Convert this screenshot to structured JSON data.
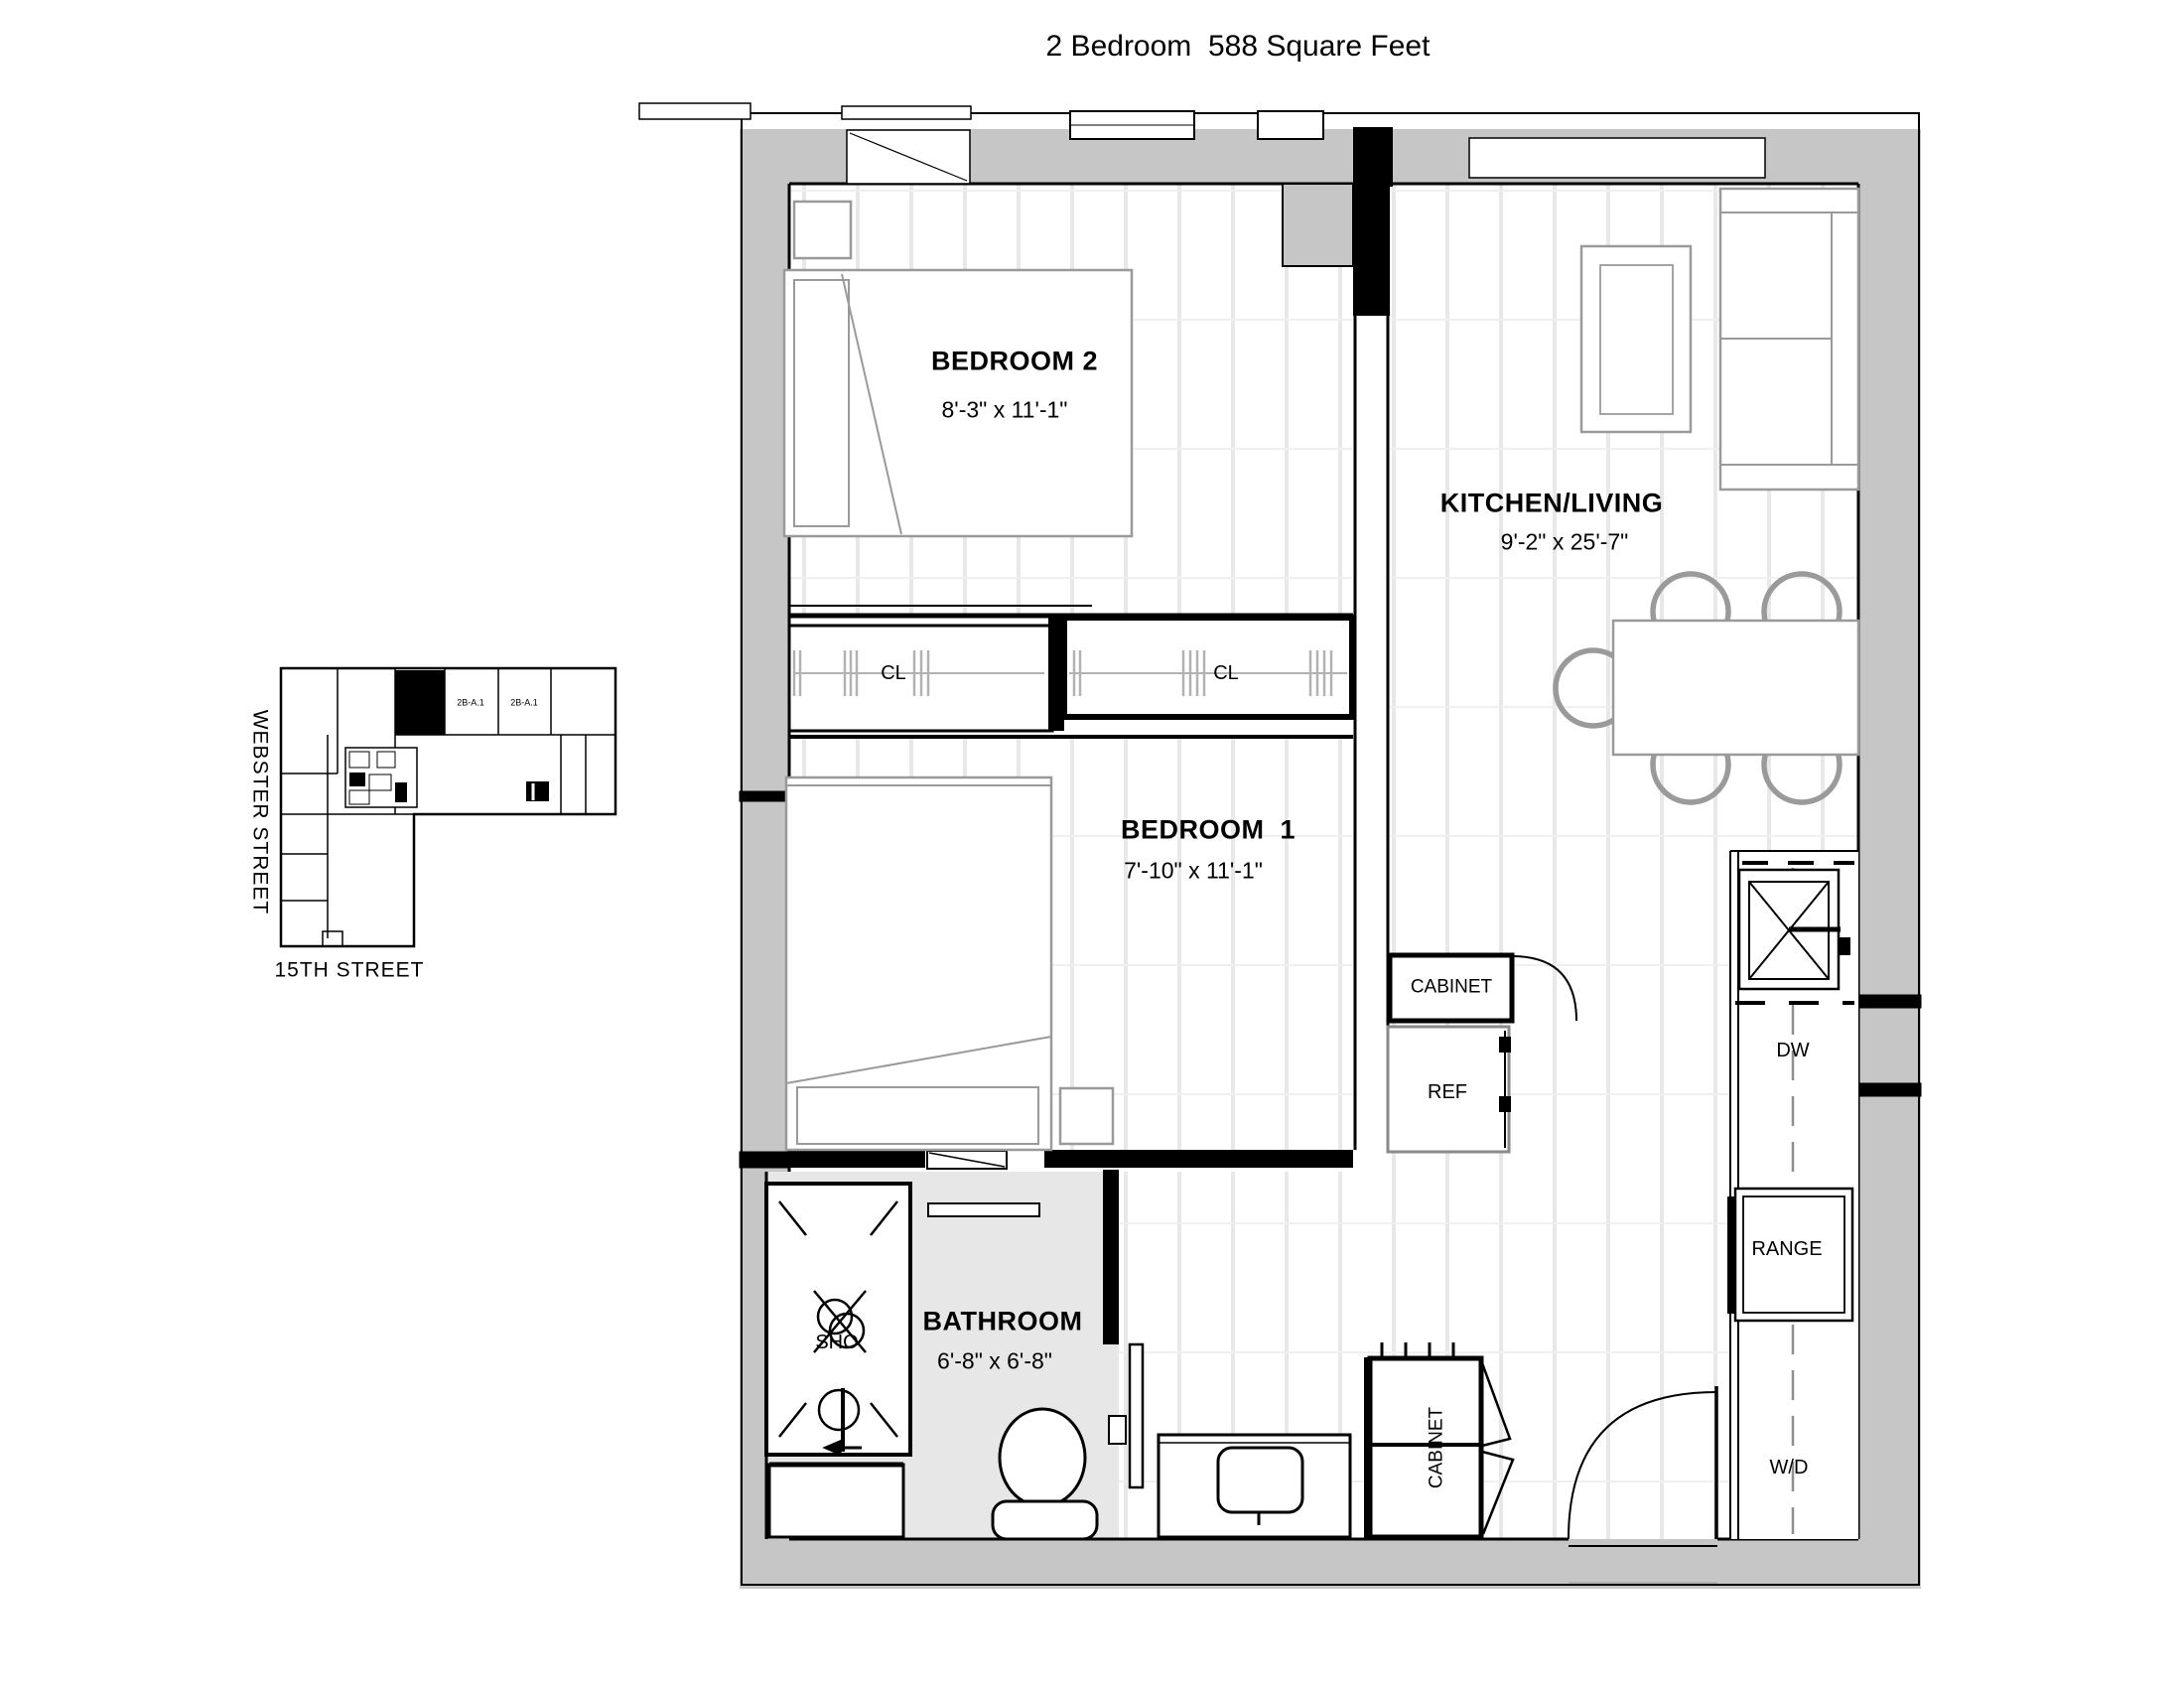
{
  "title": "2 Bedroom  588 Square Feet",
  "rooms": {
    "bedroom2": {
      "name": "BEDROOM 2",
      "dims": "8'-3\" x 11'-1\""
    },
    "bedroom1": {
      "name": "BEDROOM  1",
      "dims": "7'-10\" x 11'-1\""
    },
    "kitchen_living": {
      "name": "KITCHEN/LIVING",
      "dims": "9'-2\" x 25'-7\""
    },
    "bathroom": {
      "name": "BATHROOM",
      "dims": "6'-8\" x 6'-8\""
    }
  },
  "fixtures": {
    "closet_left": "CL",
    "closet_right": "CL",
    "cabinet_hall": "CABINET",
    "refrigerator": "REF",
    "dishwasher": "DW",
    "range": "RANGE",
    "washer_dryer": "W/D",
    "cabinet_entry": "CABINET",
    "shower": "SHO"
  },
  "key_plan": {
    "street_left": "WEBSTER STREET",
    "street_bottom": "15TH STREET",
    "units": [
      "2B-A.1",
      "2B-A.1"
    ]
  },
  "colors": {
    "wall": "#c6c6c6",
    "line": "#000000",
    "furniture": "#9a9a9a",
    "bath_floor": "#e7e7e7"
  }
}
